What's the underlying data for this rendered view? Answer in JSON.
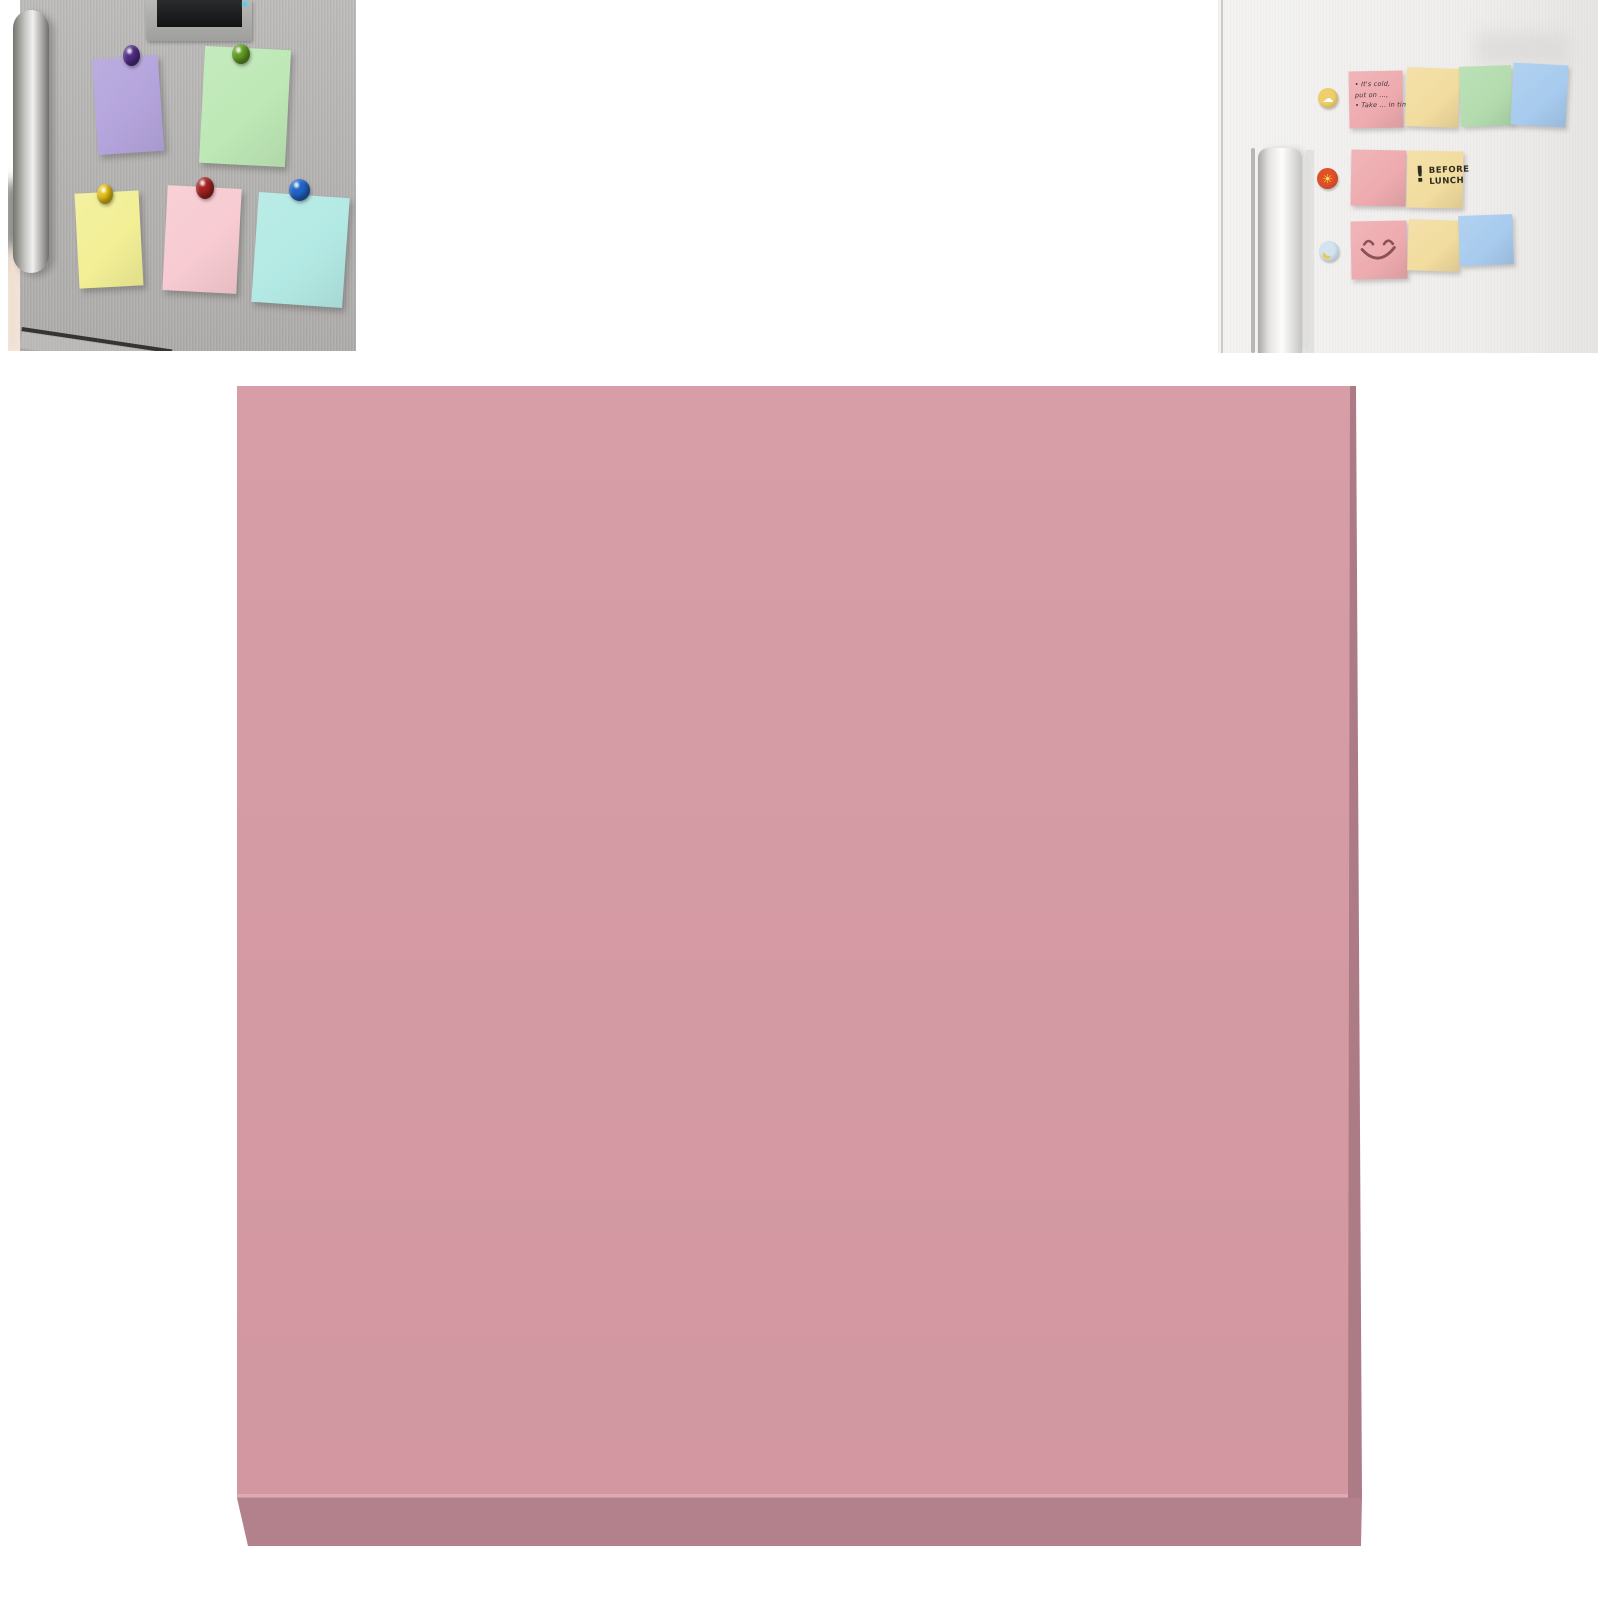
{
  "page": {
    "background": "#ffffff"
  },
  "left_photo": {
    "label": "Stainless refrigerator with five pastel sticky notes held by round magnets",
    "fridge_color": "#b5b4b2",
    "notes": [
      {
        "id": "purple",
        "color": "#b4a4dc",
        "magnet": "#4f2c86"
      },
      {
        "id": "green",
        "color": "#bee8b6",
        "magnet": "#619e23"
      },
      {
        "id": "yellow",
        "color": "#f2ef96",
        "magnet": "#e5c114"
      },
      {
        "id": "pink",
        "color": "#f7cbd1",
        "magnet": "#a42222"
      },
      {
        "id": "cyan",
        "color": "#b3e9e4",
        "magnet": "#2063c7"
      }
    ]
  },
  "right_photo": {
    "label": "White refrigerator with reminder sticky notes and icon magnets",
    "reminder_note": {
      "color": "#eeabaf",
      "lines": [
        "• It's cold,",
        "put on ...,",
        "• Take ... in time"
      ]
    },
    "lunch_note": {
      "color": "#f2dc9e",
      "exclaim": "!",
      "lines": [
        "BEFORE",
        "LUNCH"
      ]
    },
    "smiley_note": {
      "color": "#eeabaf",
      "stroke": "#8a5156"
    },
    "plain_notes": {
      "pink": "#eeabaf",
      "yellow": "#f2dc9e",
      "green": "#b3dcae",
      "blue": "#a7cbee"
    },
    "magnets": [
      {
        "id": "cloud",
        "ring": "#eecf6b",
        "glyph": "☁"
      },
      {
        "id": "sun",
        "ring": "#e0512a",
        "glyph": "☀"
      },
      {
        "id": "banana",
        "ring": "#d3e4f0"
      }
    ]
  },
  "main_pad": {
    "label": "Dusty pink sticky note pad",
    "top_color": "#d69aa4",
    "side_color": "#ad7b85",
    "bottom_color": "#b2818b"
  }
}
